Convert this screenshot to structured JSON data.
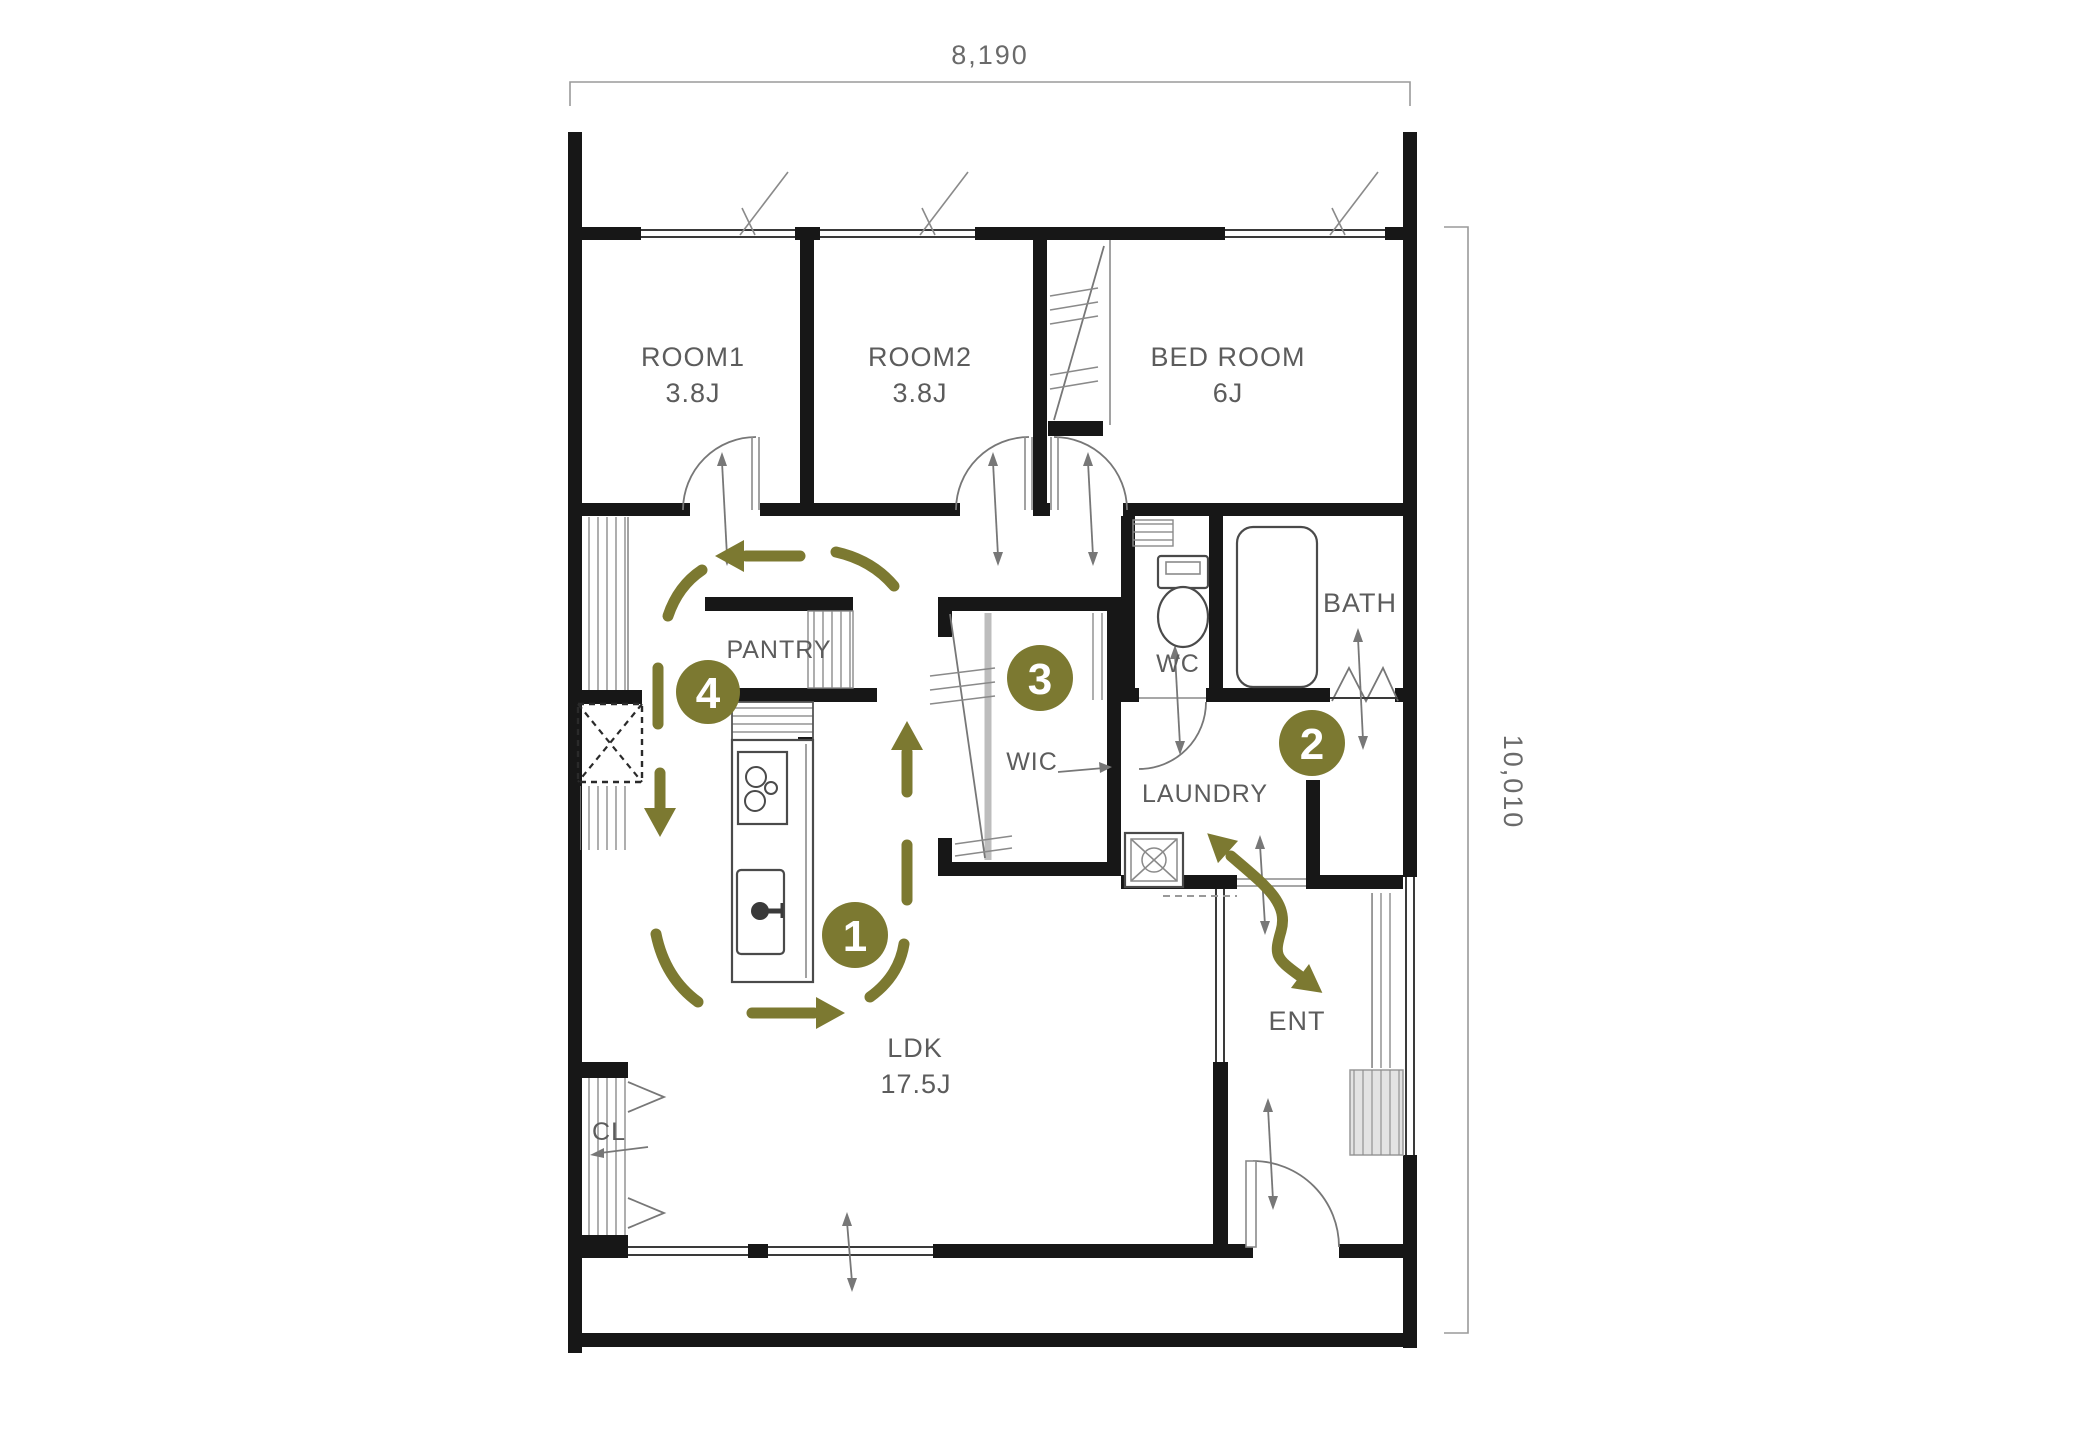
{
  "plan_title": "apartment-floor-plan",
  "dimensions": {
    "width_label": "8,190",
    "height_label": "10,010"
  },
  "rooms": {
    "room1": {
      "name": "ROOM1",
      "size": "3.8J"
    },
    "room2": {
      "name": "ROOM2",
      "size": "3.8J"
    },
    "bedroom": {
      "name": "BED ROOM",
      "size": "6J"
    },
    "wc": {
      "name": "WC"
    },
    "bath": {
      "name": "BATH"
    },
    "pantry": {
      "name": "PANTRY"
    },
    "wic": {
      "name": "WIC"
    },
    "laundry": {
      "name": "LAUNDRY"
    },
    "ldk": {
      "name": "LDK",
      "size": "17.5J"
    },
    "cl": {
      "name": "CL"
    },
    "ent": {
      "name": "ENT"
    }
  },
  "markers": [
    {
      "label": "1"
    },
    {
      "label": "2"
    },
    {
      "label": "3"
    },
    {
      "label": "4"
    }
  ],
  "colors": {
    "accent": "#7c7931",
    "wall": "#171717",
    "label": "#5c5c5c"
  }
}
